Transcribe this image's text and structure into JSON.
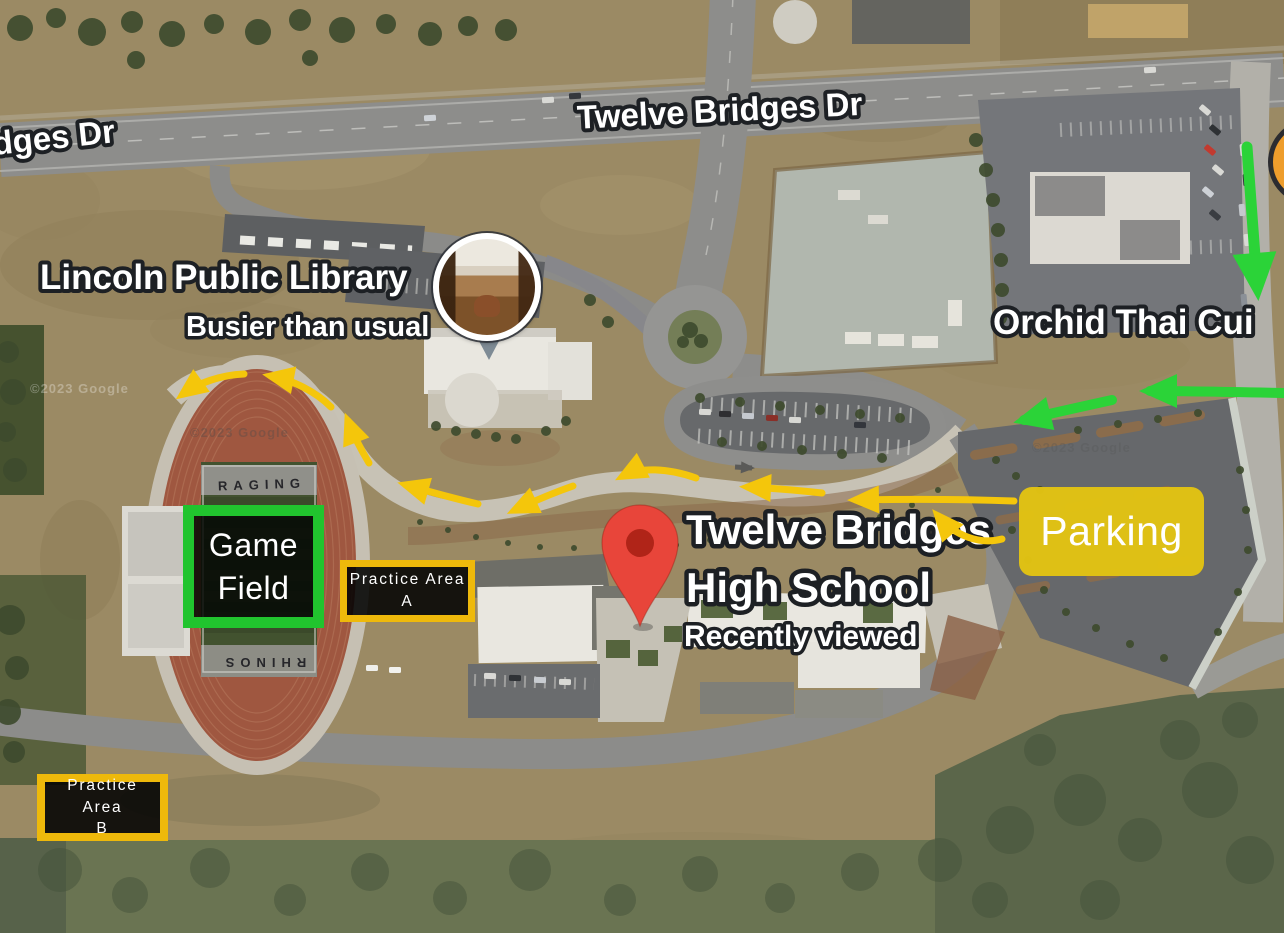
{
  "labels": {
    "street_top": "Twelve Bridges Dr",
    "street_left": "dges Dr",
    "library_name": "Lincoln Public Library",
    "library_status": "Busier than usual",
    "restaurant_name": "Orchid Thai Cui",
    "school_name_line1": "Twelve Bridges",
    "school_name_line2": "High School",
    "school_status": "Recently viewed"
  },
  "field": {
    "north_text": "RAGING",
    "south_text": "RHINOS"
  },
  "watermark": "©2023 Google",
  "annotations": {
    "game_field": {
      "line1": "Game",
      "line2": "Field",
      "border_color": "#21c42e"
    },
    "practice_area_a": {
      "line1": "Practice Area",
      "line2": "A",
      "border_color": "#eeb90b"
    },
    "practice_area_b": {
      "line1": "Practice Area",
      "line2": "B",
      "border_color": "#eeb90b"
    },
    "parking": {
      "label": "Parking",
      "fill_color": "#e2c314"
    },
    "routes": {
      "walking_color": "#f4c60b",
      "driving_color": "#2bd338"
    }
  }
}
